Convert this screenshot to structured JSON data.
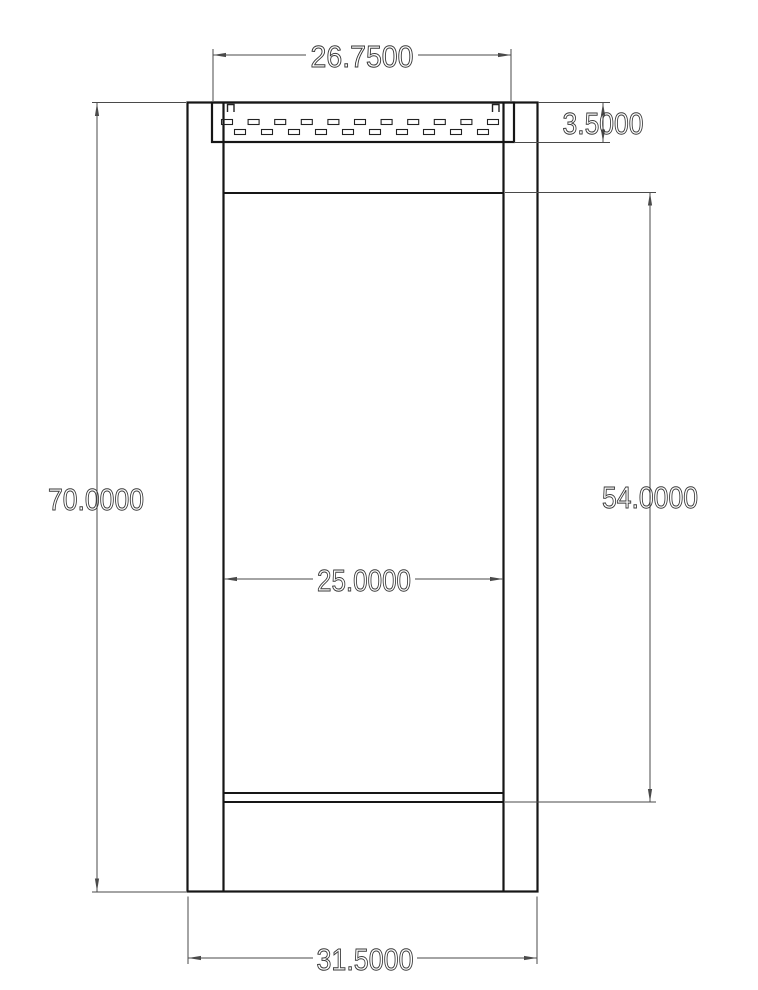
{
  "colors": {
    "background": "#ffffff",
    "frame_line": "#161616",
    "dim_line": "#4a4a4a",
    "dim_text": "#3a3a3a"
  },
  "dimensions": {
    "vent_width": "26.7500",
    "vent_height": "3.5000",
    "overall_height": "70.0000",
    "opening_height": "54.0000",
    "opening_width": "25.0000",
    "overall_width": "31.5000"
  },
  "louver": {
    "row1": {
      "count": 11,
      "start_cx": 227,
      "spacing": 26.6,
      "cy": 122,
      "width": 11,
      "height": 5
    },
    "row2": {
      "count": 10,
      "start_cx": 240,
      "spacing": 27.0,
      "cy": 132,
      "width": 11,
      "height": 5
    }
  }
}
